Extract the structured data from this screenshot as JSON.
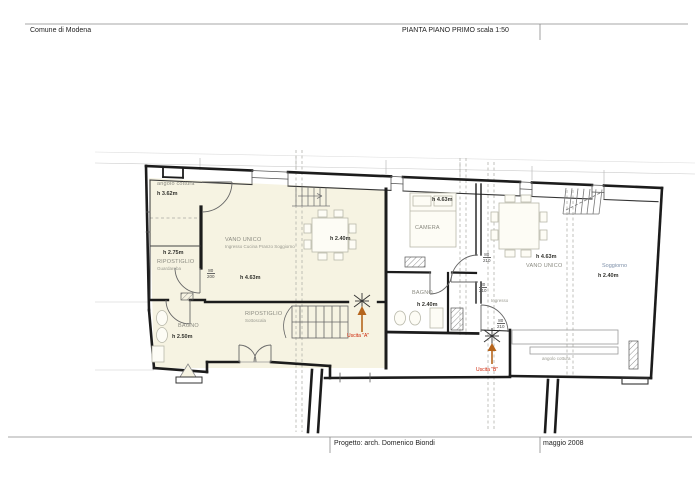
{
  "header": {
    "municipality": "Comune di Modena",
    "title": "PIANTA PIANO PRIMO  scala 1:50"
  },
  "footer": {
    "project": "Progetto:  arch. Domenico Biondi",
    "date": "maggio 2008"
  },
  "plan": {
    "unit_left": {
      "angolo_cottura": "angolo cottura",
      "h_angolo": "h 3.62m",
      "vano_unico": "VANO UNICO",
      "vano_unico_sub": "Ingresso Cucina Pranzo Soggiorno",
      "h_vano": "h 2.40m",
      "h_463": "h 4.63m",
      "ripostiglio": "RIPOSTIGLIO",
      "ripostiglio_sub": "Guardaroba",
      "h_ripostiglio": "h 2.75m",
      "bagno": "BAGNO",
      "h_bagno": "h 2.50m",
      "ripostiglio2": "RIPOSTIGLIO",
      "ripostiglio2_sub": "Sottoscala",
      "uscita_a": "Uscita \"A\""
    },
    "unit_middle": {
      "camera": "CAMERA",
      "h_camera": "h 4.63m",
      "bagno": "BAGNO",
      "h_bagno": "h 2.40m"
    },
    "unit_right": {
      "ingresso": "Ingresso",
      "vano_unico": "VANO UNICO",
      "h_vano": "h 4.63m",
      "soggiorno": "Soggiorno",
      "h_soggiorno": "h 2.40m",
      "angolo_cottura": "angolo cottura",
      "uscita_b": "Uscita \"B\""
    },
    "dims": {
      "d1": {
        "w": "80",
        "h": "200"
      },
      "d2": {
        "w": "80",
        "h": "210"
      },
      "d3": {
        "w": "80",
        "h": "210"
      },
      "d4": {
        "w": "80",
        "h": "210"
      }
    }
  },
  "colors": {
    "plan_fill": "#f6f3e2",
    "wall": "#1c1c1c",
    "exit_arrow": "#b5651d",
    "exit_label": "#cc1f00",
    "soggiorno_label": "#7d8fa8"
  }
}
